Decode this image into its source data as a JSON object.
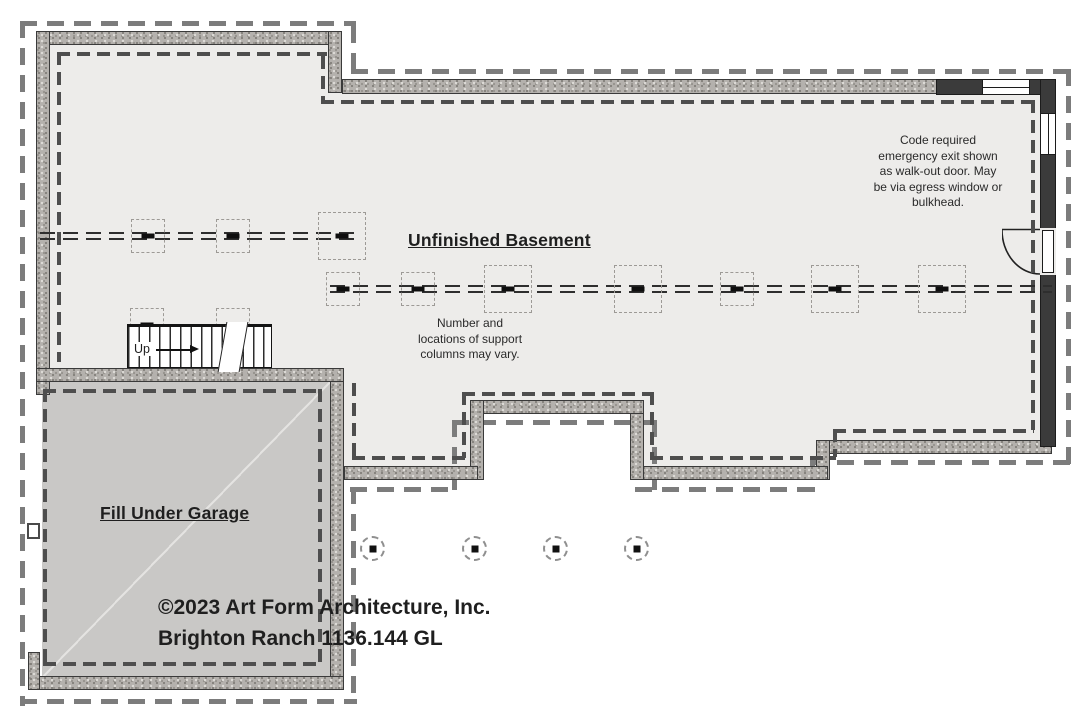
{
  "plan": {
    "room_label": "Unfinished Basement",
    "garage_label": "Fill Under Garage",
    "stairs_label": "Up",
    "columns_note_lines": [
      "Number and",
      "locations of support",
      "columns may vary."
    ],
    "egress_note_lines": [
      "Code required",
      "emergency exit shown",
      "as walk-out door. May",
      "be via egress window or",
      "bulkhead."
    ],
    "copyright_line1": "©2023 Art Form Architecture, Inc.",
    "copyright_line2": "Brighton Ranch 1136.144 GL",
    "colors": {
      "floor": "#edecea",
      "garage_fill": "#c9c8c6",
      "foundation_wall": "#b4b1ad",
      "framed_wall": "#3b3b3b",
      "footing_dash": "#7c7c7c",
      "slab_dash": "#4e4e4e",
      "text": "#1f1f1f"
    }
  }
}
